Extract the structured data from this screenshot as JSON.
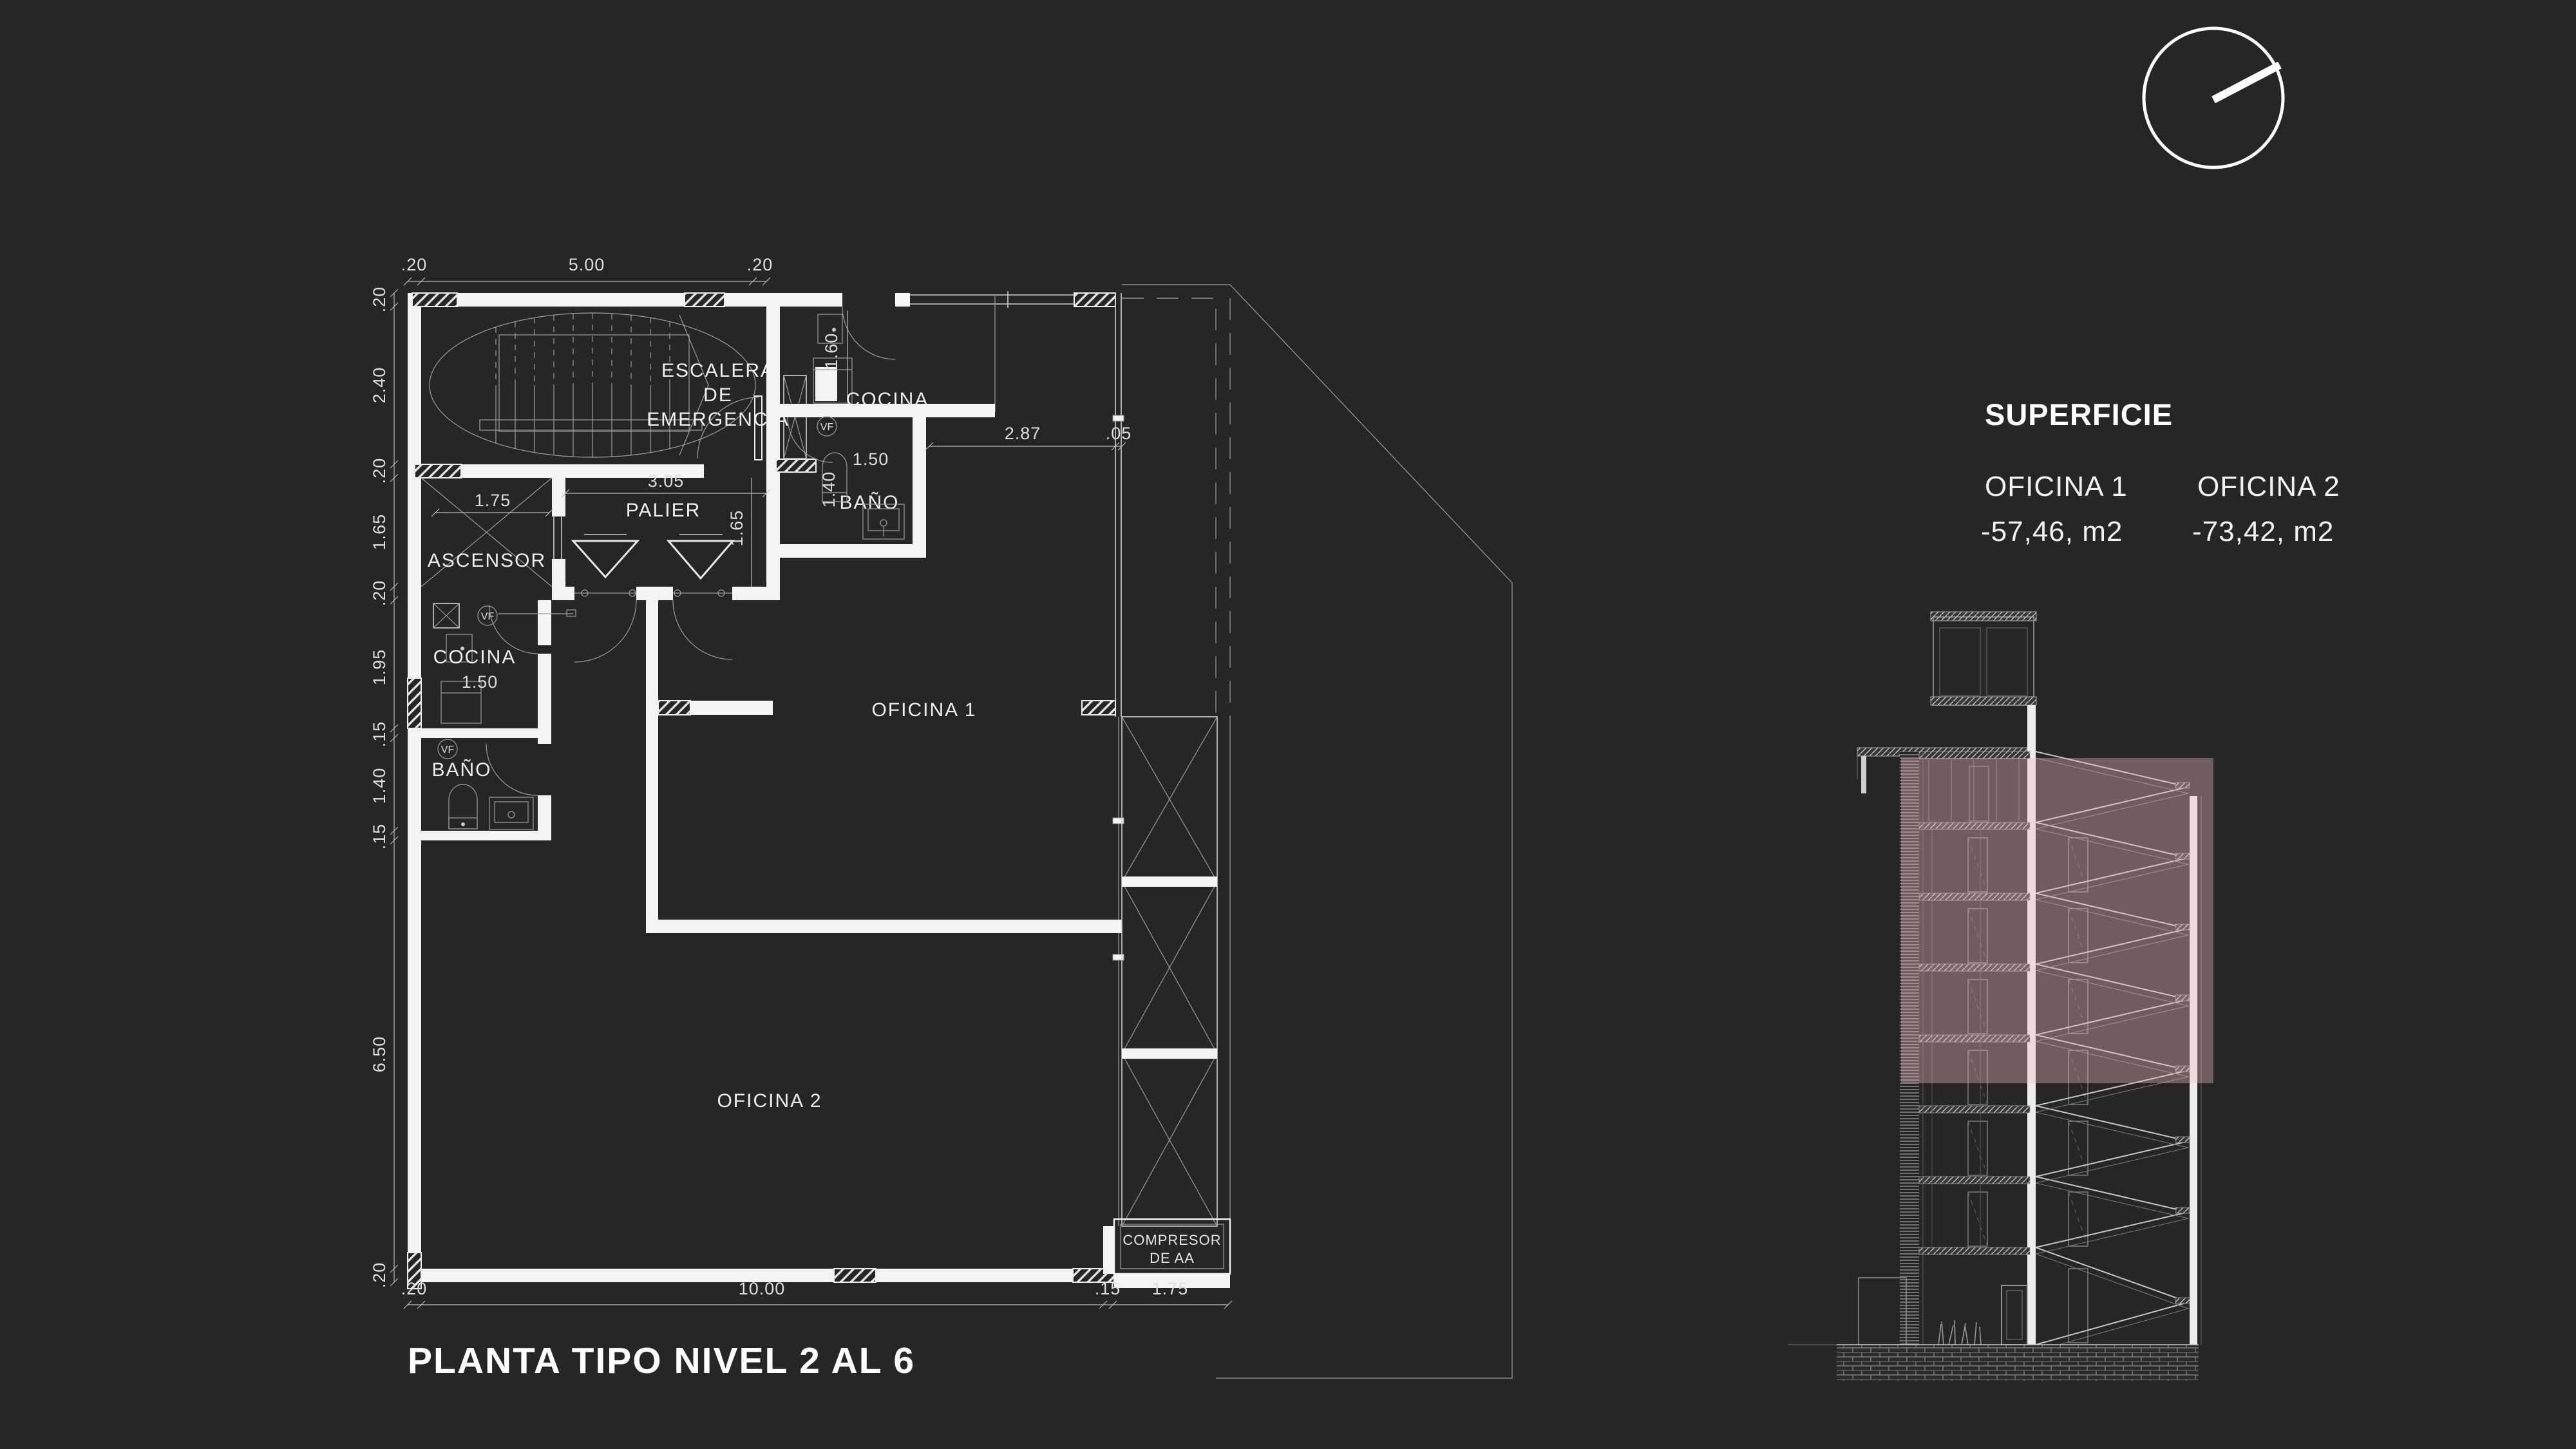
{
  "page": {
    "background": "#262626",
    "line_color": "#f4f4f4",
    "highlight_color": "#f2bcc3"
  },
  "title": "PLANTA TIPO NIVEL 2 AL 6",
  "superficie": {
    "heading": "SUPERFICIE",
    "items": [
      {
        "name": "OFICINA 1",
        "area": "-57,46, m2"
      },
      {
        "name": "OFICINA 2",
        "area": "-73,42, m2"
      }
    ]
  },
  "plan": {
    "rooms": {
      "stair": [
        "ESCALERA",
        "DE",
        "EMERGENCIA"
      ],
      "elevator": "ASCENSOR",
      "landing": "PALIER",
      "kitchen_top": "COCINA",
      "bath_top": "BAÑO",
      "kitchen_left": "COCINA",
      "bath_left": "BAÑO",
      "office1": "OFICINA 1",
      "office2": "OFICINA 2",
      "compressor": [
        "COMPRESOR",
        "DE AA"
      ],
      "vf_label": "VF"
    },
    "dims": {
      "top": [
        ".20",
        "5.00",
        ".20"
      ],
      "left": [
        ".20",
        "2.40",
        ".20",
        "1.65",
        ".20",
        "1.95",
        ".15",
        "1.40",
        ".15",
        "6.50",
        ".20"
      ],
      "bottom": [
        ".20",
        "10.00",
        ".15",
        "1.75"
      ],
      "landing_width": "3.05",
      "landing_depth": "1.65",
      "elevator_width": "1.75",
      "kitchen_top_depth": "1.60",
      "bath_top_width": "1.50",
      "bath_top_depth": "1.40",
      "office1_width": "2.87",
      "office1_gap": ".05",
      "kitchen_left_width": "1.50"
    }
  }
}
